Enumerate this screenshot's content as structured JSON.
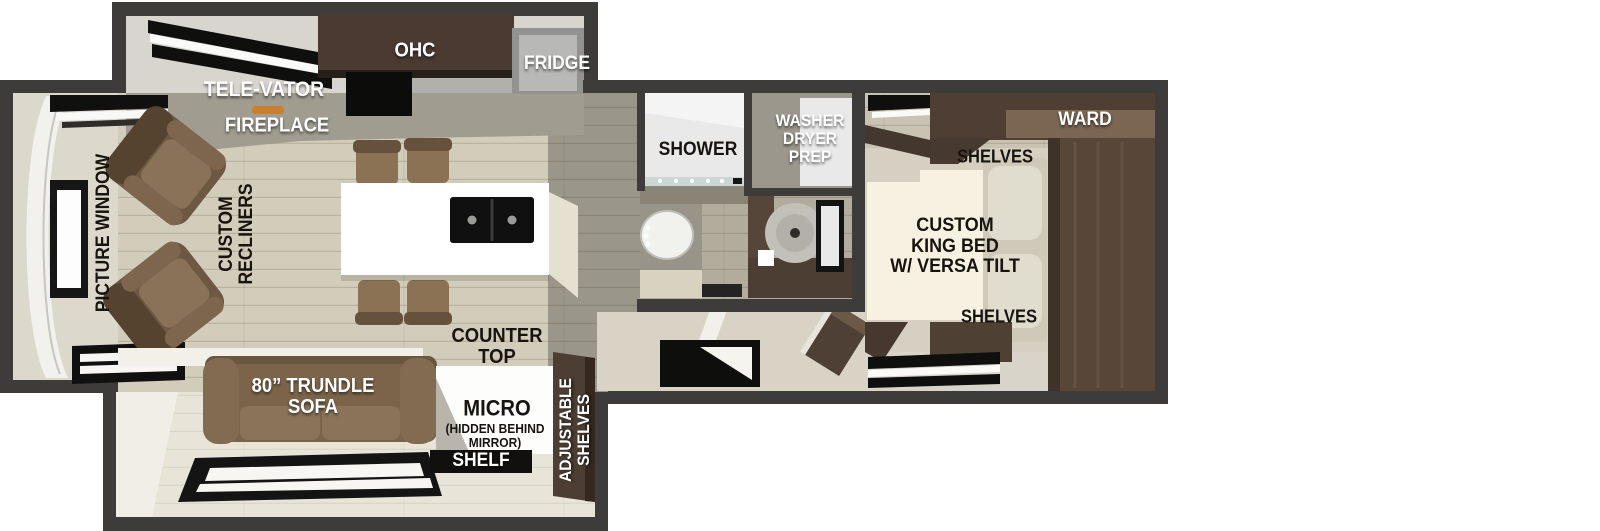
{
  "labels": {
    "kitchen": {
      "televator": "TELE-VATOR",
      "ohc": "OHC",
      "fridge": "FRIDGE",
      "fireplace": "FIREPLACE"
    },
    "living": {
      "picture_window": "PICTURE WINDOW",
      "custom_recliners": "CUSTOM\nRECLINERS",
      "counter_top": "COUNTER\nTOP",
      "trundle_sofa": "80” TRUNDLE\nSOFA",
      "micro": "MICRO",
      "micro_note": "(HIDDEN BEHIND\nMIRROR)",
      "shelf": "SHELF",
      "adjustable_shelves": "ADJUSTABLE\nSHELVES"
    },
    "bath": {
      "shower": "SHOWER",
      "washer_dryer_prep": "WASHER\nDRYER\nPREP"
    },
    "bedroom": {
      "ward": "WARD",
      "shelves_top": "SHELVES",
      "king_bed": "CUSTOM\nKING BED\nW/ VERSA TILT",
      "shelves_bottom": "SHELVES"
    }
  },
  "colors": {
    "wall": "#3d3c3a",
    "wood_floor": "#d2ccba",
    "aisle_floor": "#9b968a",
    "bath_floor": "#b2ac9d",
    "bedroom_floor": "#c9c3b3",
    "slide_floor": "#e8e4d8",
    "cabinet_brown": "#4c3d33",
    "sofa_brown": "#7b644a",
    "fireplace_glow": "#c87f2e",
    "label_white": "#ffffff",
    "label_black": "#17140f"
  }
}
